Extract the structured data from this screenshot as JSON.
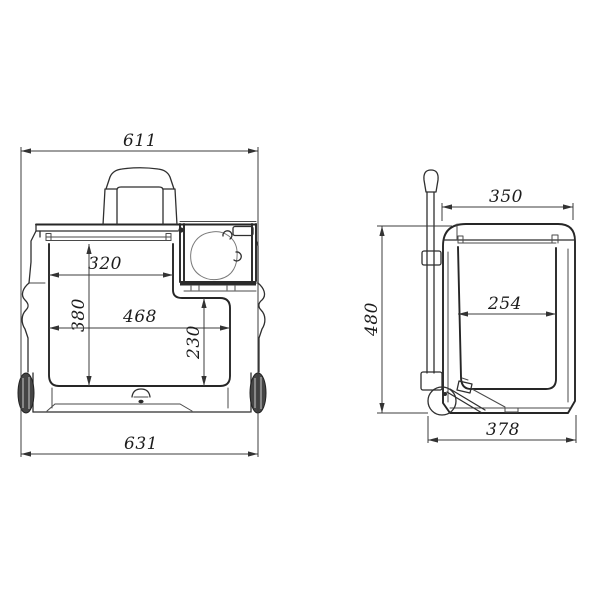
{
  "canvas": {
    "background": "#ffffff",
    "line_color": "#2f2f2f",
    "dim_line_color": "#3c3c3c",
    "dim_text_color": "#1c1c1c"
  },
  "views": {
    "front": {
      "dims": {
        "overall_top_width": "611",
        "inner_width_upper": "320",
        "inner_height": "380",
        "inner_width_lower": "468",
        "compartment_height": "230",
        "overall_bottom_width": "631"
      }
    },
    "side": {
      "dims": {
        "top_depth": "350",
        "overall_height": "480",
        "inner_depth": "254",
        "bottom_depth": "378"
      }
    }
  }
}
